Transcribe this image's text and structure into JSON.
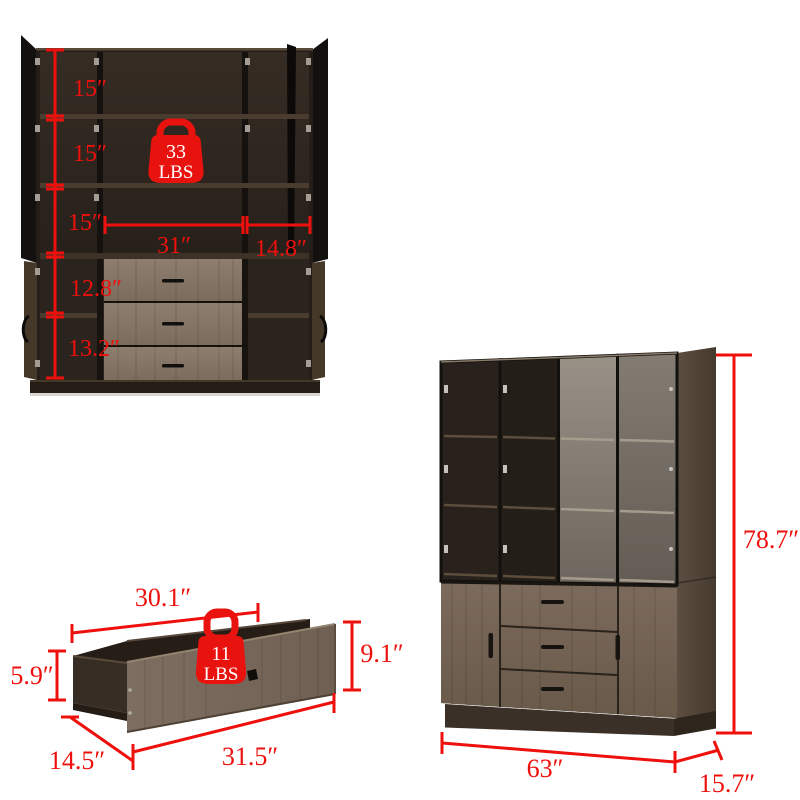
{
  "image_type": "furniture product dimension diagram",
  "accent_red": "#ee100c",
  "background": "#ffffff",
  "open_cabinet": {
    "weight_badge": {
      "value": "33",
      "unit": "LBS"
    },
    "dims": {
      "top_section_1": "15″",
      "top_section_2": "15″",
      "top_section_3": "15″",
      "lower_section_1": "12.8″",
      "lower_section_2": "13.2″",
      "middle_width": "31″",
      "right_width": "14.8″"
    }
  },
  "drawer": {
    "weight_badge": {
      "value": "11",
      "unit": "LBS"
    },
    "dims": {
      "inner_width": "30.1″",
      "box_height": "5.9″",
      "depth": "14.5″",
      "front_width": "31.5″",
      "front_height": "9.1″"
    }
  },
  "closed_cabinet": {
    "dims": {
      "height": "78.7″",
      "width": "63″",
      "depth": "15.7″"
    }
  }
}
